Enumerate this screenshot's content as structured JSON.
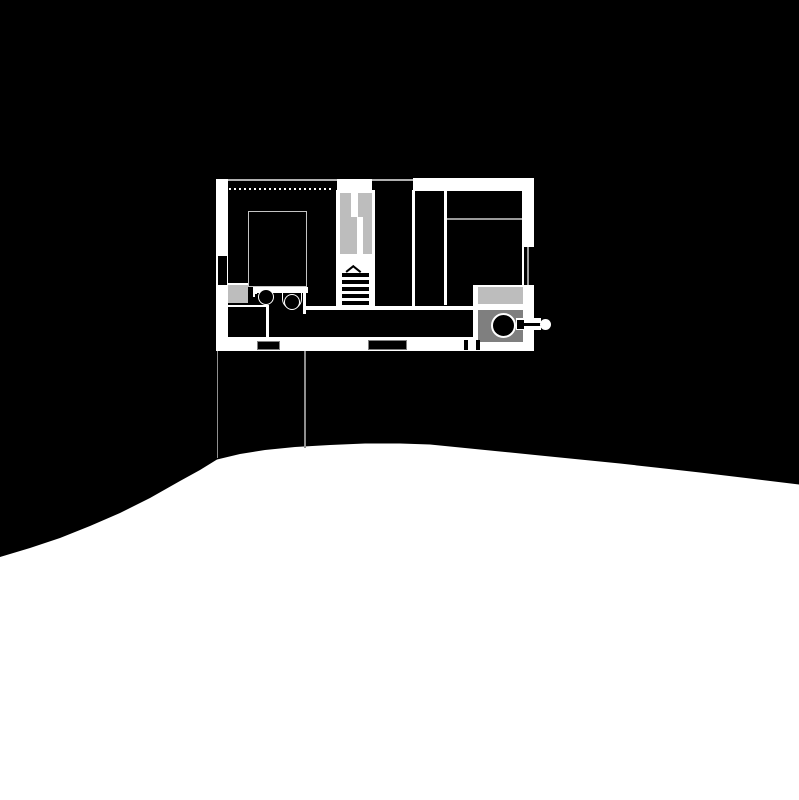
{
  "scene": {
    "width": 799,
    "height": 800,
    "background": "#000000",
    "kind": "architectural-floor-plan-with-site-section"
  },
  "palette": {
    "wall_white": "#ffffff",
    "thin_line_gray": "#b0b0b0",
    "light_gray": "#bdbdbd",
    "mid_gray": "#7f7f7f",
    "outline_gray": "#999999",
    "projection_gray": "#8f8f8f",
    "black": "#000000"
  },
  "terrain": {
    "fill": "#ffffff",
    "points": [
      [
        0,
        557
      ],
      [
        30,
        548
      ],
      [
        60,
        538
      ],
      [
        90,
        526
      ],
      [
        120,
        513
      ],
      [
        150,
        498
      ],
      [
        180,
        481
      ],
      [
        200,
        470
      ],
      [
        217,
        459.5
      ],
      [
        240,
        454
      ],
      [
        265,
        450
      ],
      [
        295,
        447
      ],
      [
        330,
        445
      ],
      [
        365,
        443.5
      ],
      [
        400,
        443.5
      ],
      [
        430,
        444.5
      ],
      [
        465,
        448
      ],
      [
        500,
        451.5
      ],
      [
        540,
        455.5
      ],
      [
        580,
        459.5
      ],
      [
        620,
        463.5
      ],
      [
        660,
        468
      ],
      [
        700,
        472.5
      ],
      [
        750,
        478.5
      ],
      [
        799,
        484.5
      ],
      [
        799,
        800
      ],
      [
        0,
        800
      ]
    ]
  },
  "elements": [
    {
      "name": "projection-line-left",
      "type": "rect",
      "x": 216.8,
      "y": 351,
      "w": 1.4,
      "h": 107,
      "fill": "#8f8f8f"
    },
    {
      "name": "projection-line-right",
      "type": "rect",
      "x": 304.4,
      "y": 351,
      "w": 1.4,
      "h": 96.5,
      "fill": "#8f8f8f"
    },
    {
      "name": "top-wall-line",
      "type": "rect",
      "x": 228,
      "y": 179,
      "w": 185,
      "h": 1.6,
      "fill": "#b0b0b0"
    },
    {
      "name": "ceiling-dotted-line",
      "type": "dotted",
      "x": 229,
      "y": 187.5,
      "w": 104,
      "h": 2,
      "fill": "#ffffff",
      "dash": 2,
      "gap": 3
    },
    {
      "name": "entry-opening",
      "type": "rect",
      "x": 336.5,
      "y": 179,
      "w": 35.5,
      "h": 13.5,
      "fill": "#ffffff"
    },
    {
      "name": "top-wall",
      "type": "rect",
      "x": 413,
      "y": 178,
      "w": 121,
      "h": 12.5,
      "fill": "#ffffff"
    },
    {
      "name": "left-wall-upper",
      "type": "rect",
      "x": 216,
      "y": 179,
      "w": 12,
      "h": 77,
      "fill": "#ffffff"
    },
    {
      "name": "left-window-line-outer",
      "type": "rect",
      "x": 216,
      "y": 256,
      "w": 1.5,
      "h": 29,
      "fill": "#ffffff"
    },
    {
      "name": "left-window-line-inner",
      "type": "rect",
      "x": 226.5,
      "y": 256,
      "w": 1.5,
      "h": 29,
      "fill": "#ffffff"
    },
    {
      "name": "left-wall-lower",
      "type": "rect",
      "x": 216,
      "y": 285,
      "w": 12,
      "h": 66,
      "fill": "#ffffff"
    },
    {
      "name": "right-wall-upper",
      "type": "rect",
      "x": 522,
      "y": 190,
      "w": 12,
      "h": 57,
      "fill": "#ffffff"
    },
    {
      "name": "right-window-line-inner",
      "type": "rect",
      "x": 521.5,
      "y": 247,
      "w": 2,
      "h": 38,
      "fill": "#ffffff"
    },
    {
      "name": "right-window-line-outer",
      "type": "rect",
      "x": 527,
      "y": 247,
      "w": 1.5,
      "h": 38,
      "fill": "#999999"
    },
    {
      "name": "stove-room-floor",
      "type": "rect",
      "x": 473,
      "y": 285,
      "w": 61,
      "h": 66,
      "fill": "#ffffff"
    },
    {
      "name": "bottom-wall",
      "type": "rect",
      "x": 216,
      "y": 337,
      "w": 318,
      "h": 14,
      "fill": "#ffffff"
    },
    {
      "name": "stair-left-wall",
      "type": "rect",
      "x": 336,
      "y": 190,
      "w": 2.5,
      "h": 118,
      "fill": "#ffffff"
    },
    {
      "name": "stair-well",
      "type": "rect",
      "x": 338.5,
      "y": 190,
      "w": 33.5,
      "h": 118,
      "fill": "#ffffff"
    },
    {
      "name": "stair-right-wall",
      "type": "rect",
      "x": 372,
      "y": 190,
      "w": 3,
      "h": 118,
      "fill": "#ffffff"
    },
    {
      "name": "hall-east-wall",
      "type": "rect",
      "x": 412,
      "y": 190,
      "w": 3,
      "h": 117,
      "fill": "#ffffff"
    },
    {
      "name": "bedroom-west-wall",
      "type": "rect",
      "x": 443.5,
      "y": 190,
      "w": 3,
      "h": 115,
      "fill": "#ffffff"
    },
    {
      "name": "counter-edge-line",
      "type": "rect",
      "x": 306,
      "y": 306,
      "w": 172,
      "h": 3.5,
      "fill": "#ffffff"
    },
    {
      "name": "bath-wall-band",
      "type": "rect",
      "x": 254,
      "y": 287,
      "w": 54,
      "h": 6,
      "fill": "#ffffff"
    },
    {
      "name": "bath-left-stub",
      "type": "rect",
      "x": 252.5,
      "y": 287,
      "w": 2.5,
      "h": 10,
      "fill": "#ffffff"
    },
    {
      "name": "bath-east-wall",
      "type": "rect",
      "x": 303,
      "y": 287,
      "w": 3,
      "h": 27,
      "fill": "#ffffff"
    },
    {
      "name": "shower-top-line",
      "type": "rect",
      "x": 228,
      "y": 282.5,
      "w": 20,
      "h": 2.5,
      "fill": "#ffffff"
    },
    {
      "name": "closet-backer",
      "type": "rect",
      "x": 228,
      "y": 304.5,
      "w": 41,
      "h": 33,
      "fill": "#ffffff"
    },
    {
      "name": "closet-block",
      "type": "rect",
      "x": 228,
      "y": 307,
      "w": 38,
      "h": 30,
      "fill": "#000000"
    },
    {
      "name": "shower-box",
      "type": "rect",
      "x": 228,
      "y": 285,
      "w": 20,
      "h": 18,
      "fill": "#bdbdbd"
    },
    {
      "name": "stair-flight-left-upper",
      "type": "rect",
      "x": 339.5,
      "y": 193,
      "w": 11.5,
      "h": 24,
      "fill": "#bdbdbd"
    },
    {
      "name": "stair-flight-left-lower",
      "type": "rect",
      "x": 339.5,
      "y": 217,
      "w": 17.5,
      "h": 37,
      "fill": "#bdbdbd"
    },
    {
      "name": "stair-flight-right-upper",
      "type": "rect",
      "x": 358,
      "y": 193,
      "w": 13.5,
      "h": 24,
      "fill": "#bdbdbd"
    },
    {
      "name": "stair-flight-right-lower",
      "type": "rect",
      "x": 362.5,
      "y": 217,
      "w": 9,
      "h": 37,
      "fill": "#bdbdbd"
    },
    {
      "name": "bed-headboard-line",
      "type": "rect",
      "x": 446.5,
      "y": 217.5,
      "w": 75,
      "h": 2,
      "fill": "#9a9a9a"
    },
    {
      "name": "stove-shelf",
      "type": "rect",
      "x": 478,
      "y": 286.5,
      "w": 45,
      "h": 17,
      "fill": "#bdbdbd"
    },
    {
      "name": "stove-hearth",
      "type": "rect",
      "x": 478,
      "y": 310,
      "w": 45,
      "h": 32,
      "fill": "#7f7f7f"
    },
    {
      "name": "bed-outline",
      "type": "rect",
      "x": 248,
      "y": 211,
      "w": 59,
      "h": 76,
      "fill": "transparent",
      "border": "1.6px solid #c4c4c4"
    },
    {
      "name": "stair-tread",
      "type": "rect",
      "x": 341.5,
      "y": 273,
      "w": 27,
      "h": 4,
      "fill": "#000000"
    },
    {
      "name": "stair-tread",
      "type": "rect",
      "x": 341.5,
      "y": 280,
      "w": 27,
      "h": 4,
      "fill": "#000000"
    },
    {
      "name": "stair-tread",
      "type": "rect",
      "x": 341.5,
      "y": 287,
      "w": 27,
      "h": 4,
      "fill": "#000000"
    },
    {
      "name": "stair-tread",
      "type": "rect",
      "x": 341.5,
      "y": 294,
      "w": 27,
      "h": 4,
      "fill": "#000000"
    },
    {
      "name": "stair-tread",
      "type": "rect",
      "x": 341.5,
      "y": 301,
      "w": 27,
      "h": 4,
      "fill": "#000000"
    },
    {
      "name": "stair-direction-arrow",
      "type": "seg",
      "x1": 345.5,
      "y1": 271.5,
      "x2": 353,
      "y2": 265.5,
      "t": 1.6,
      "fill": "#000000"
    },
    {
      "name": "stair-direction-arrow",
      "type": "seg",
      "x1": 353,
      "y1": 265.5,
      "x2": 360.5,
      "y2": 271.5,
      "t": 1.6,
      "fill": "#000000"
    },
    {
      "name": "door-mat-west",
      "type": "rect",
      "x": 257,
      "y": 341,
      "w": 23,
      "h": 9,
      "fill": "#000000",
      "border": "1px solid #808080"
    },
    {
      "name": "door-mat-south",
      "type": "rect",
      "x": 368,
      "y": 340,
      "w": 39,
      "h": 10,
      "fill": "#000000",
      "border": "1px solid #808080"
    },
    {
      "name": "door-dash-a",
      "type": "rect",
      "x": 463.5,
      "y": 340,
      "w": 4,
      "h": 10,
      "fill": "#000000"
    },
    {
      "name": "door-dash-b",
      "type": "rect",
      "x": 475.5,
      "y": 340,
      "w": 4,
      "h": 10,
      "fill": "#000000"
    },
    {
      "name": "toilet-bowl",
      "type": "circle",
      "cx": 266,
      "cy": 296.5,
      "r": 8,
      "fill": "#000000",
      "stroke": "1.6px solid #ffffff"
    },
    {
      "name": "toilet-tick",
      "type": "rect",
      "x": 254.5,
      "y": 288.5,
      "w": 2,
      "h": 5,
      "fill": "#ffffff"
    },
    {
      "name": "sink-basin",
      "type": "urect",
      "x": 281.5,
      "y": 288,
      "w": 20,
      "h": 21,
      "t": 1.6,
      "stroke_color": "#ffffff",
      "radius": 10
    },
    {
      "name": "sink-bowl",
      "type": "circle",
      "cx": 291.5,
      "cy": 301.5,
      "r": 8,
      "fill": "#000000",
      "stroke": "1.6px solid #ffffff"
    },
    {
      "name": "stove-body",
      "type": "circle",
      "cx": 503.5,
      "cy": 325.5,
      "r": 12.5,
      "fill": "#000000",
      "stroke": "2px solid #ffffff"
    },
    {
      "name": "flue-backer",
      "type": "rect",
      "x": 516,
      "y": 318,
      "w": 25,
      "h": 12,
      "fill": "#ffffff"
    },
    {
      "name": "flue-stub",
      "type": "rect",
      "x": 516.5,
      "y": 319.5,
      "w": 7,
      "h": 9,
      "fill": "#000000"
    },
    {
      "name": "flue-pipe",
      "type": "rect",
      "x": 523.5,
      "y": 322.5,
      "w": 22,
      "h": 3,
      "fill": "#000000"
    },
    {
      "name": "flue-cap",
      "type": "circle",
      "cx": 545,
      "cy": 324,
      "r": 5.5,
      "fill": "#ffffff",
      "stroke": "none"
    }
  ]
}
